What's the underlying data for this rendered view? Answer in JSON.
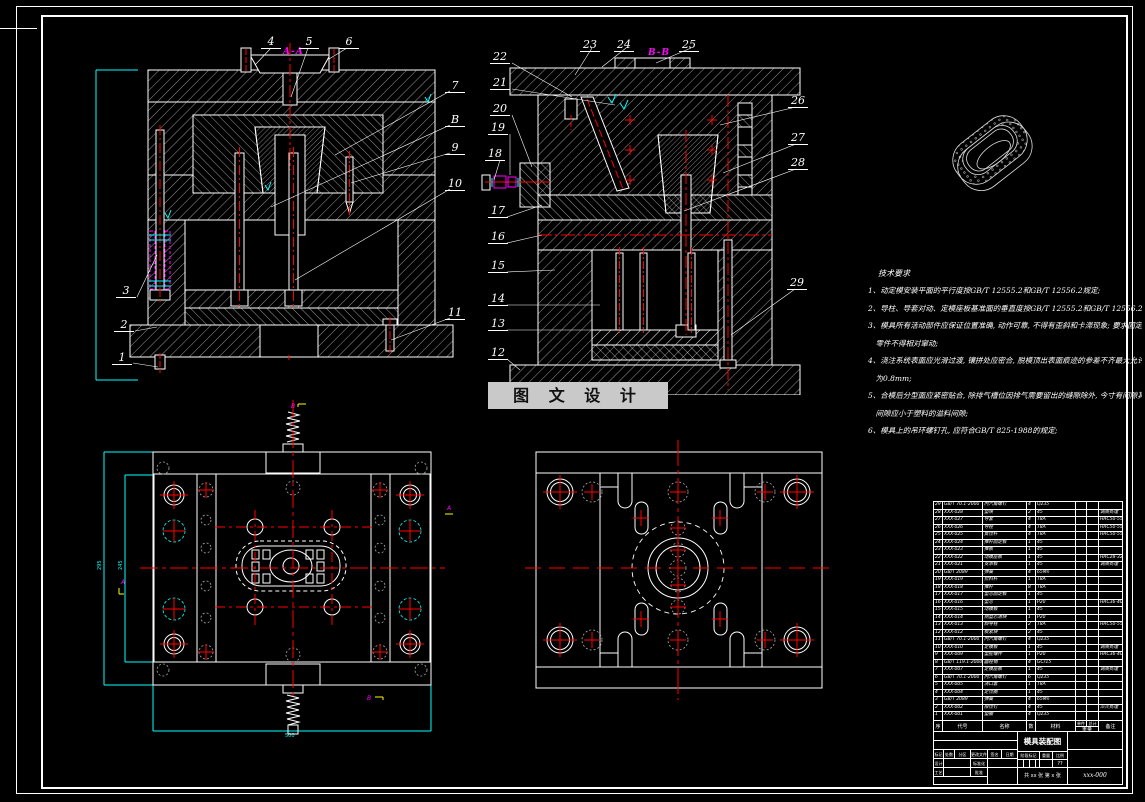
{
  "colors": {
    "background": "#000000",
    "line": "#ffffff",
    "centerline": "#ff0000",
    "dimension": "#00ffff",
    "highlight": "#ff00ff",
    "mark_yellow": "#ffff00",
    "watermark_bg": "#c9c9c9",
    "watermark_text": "#111111",
    "ghost_grey": "#aaaaaa"
  },
  "watermark": {
    "text": "图 文 设 计"
  },
  "section_labels": {
    "a": "A-A",
    "b": "B-B"
  },
  "view_a": {
    "callouts_top": [
      "4",
      "5",
      "6"
    ],
    "callouts_left": [
      "3",
      "2",
      "1"
    ],
    "callouts_right": [
      "7",
      "B",
      "9",
      "10",
      "11"
    ]
  },
  "view_b": {
    "callouts_top": [
      "23",
      "24",
      "25"
    ],
    "callouts_left": [
      "22",
      "21",
      "20",
      "19",
      "18",
      "17",
      "16",
      "15",
      "14",
      "13",
      "12"
    ],
    "callouts_right": [
      "26",
      "27",
      "28",
      "29"
    ]
  },
  "dims": {
    "view_a_height": "245",
    "plan_left_height": "295",
    "plan_left_inner": "245",
    "plan_left_width": "500"
  },
  "tech_notes": {
    "title": "技术要求",
    "lines": [
      "1、动定模安装平面的平行度按GB/T 12555.2和GB/T 12556.2规定;",
      "2、导柱、导套对动、定模座板基准面的垂直度按GB/T 12555.2和GB/T 12556.2;",
      "3、模具所有活动部件应保证位置准确, 动作可靠, 不得有歪斜和卡滞现象; 要求固定的",
      "　零件不得相对窜动;",
      "4、浇注系统表面应光滑过渡, 镶拼处应密合, 脱模顶出表面痕迹的参差不齐最大允许值",
      "　为0.8mm;",
      "5、合模后分型面应紧密贴合, 除排气槽位因排气需要留出的缝隙除外, 今寸有间隙其",
      "　间隙应小于塑料的溢料间隙;",
      "6、模具上的吊环螺钉孔, 应符合GB/T 825-1988的规定;"
    ]
  },
  "bom": {
    "headers": {
      "no": "序号",
      "code": "代号",
      "name": "名称",
      "qty": "数量",
      "mat": "材料",
      "weight": "重量",
      "unit": "单件",
      "total": "总计",
      "remark": "备注"
    },
    "rows": [
      {
        "no": "29",
        "code": "GB/T 70.1-2000",
        "name": "内六角螺钉",
        "qty": "4",
        "mat": "Q235",
        "unit": "",
        "total": "",
        "remark": ""
      },
      {
        "no": "28",
        "code": "XXX-028",
        "name": "垫块",
        "qty": "2",
        "mat": "45",
        "unit": "",
        "total": "",
        "remark": "调质处理"
      },
      {
        "no": "27",
        "code": "XXX-027",
        "name": "导套",
        "qty": "4",
        "mat": "T8A",
        "unit": "",
        "total": "",
        "remark": "HRC50-55"
      },
      {
        "no": "26",
        "code": "XXX-026",
        "name": "导柱",
        "qty": "4",
        "mat": "T8A",
        "unit": "",
        "total": "",
        "remark": "HRC50-55"
      },
      {
        "no": "25",
        "code": "XXX-025",
        "name": "复位杆",
        "qty": "4",
        "mat": "T8A",
        "unit": "",
        "total": "",
        "remark": "HRC50-55"
      },
      {
        "no": "24",
        "code": "XXX-024",
        "name": "推杆固定板",
        "qty": "1",
        "mat": "45",
        "unit": "",
        "total": "",
        "remark": ""
      },
      {
        "no": "23",
        "code": "XXX-023",
        "name": "推板",
        "qty": "1",
        "mat": "45",
        "unit": "",
        "total": "",
        "remark": ""
      },
      {
        "no": "22",
        "code": "XXX-022",
        "name": "动模座板",
        "qty": "1",
        "mat": "45",
        "unit": "",
        "total": "",
        "remark": "HRC28-32"
      },
      {
        "no": "21",
        "code": "XXX-021",
        "name": "支承板",
        "qty": "1",
        "mat": "45",
        "unit": "",
        "total": "",
        "remark": "调质处理"
      },
      {
        "no": "20",
        "code": "GB/T 2089",
        "name": "弹簧",
        "qty": "4",
        "mat": "65Mn",
        "unit": "",
        "total": "",
        "remark": ""
      },
      {
        "no": "19",
        "code": "XXX-019",
        "name": "拉料杆",
        "qty": "1",
        "mat": "T8A",
        "unit": "",
        "total": "",
        "remark": ""
      },
      {
        "no": "18",
        "code": "XXX-018",
        "name": "推杆",
        "qty": "8",
        "mat": "T8A",
        "unit": "",
        "total": "",
        "remark": ""
      },
      {
        "no": "17",
        "code": "XXX-017",
        "name": "型芯固定板",
        "qty": "1",
        "mat": "45",
        "unit": "",
        "total": "",
        "remark": ""
      },
      {
        "no": "16",
        "code": "XXX-016",
        "name": "型芯",
        "qty": "1",
        "mat": "P20",
        "unit": "",
        "total": "",
        "remark": "HRC36-40"
      },
      {
        "no": "15",
        "code": "XXX-015",
        "name": "动模板",
        "qty": "1",
        "mat": "45",
        "unit": "",
        "total": "",
        "remark": ""
      },
      {
        "no": "14",
        "code": "XXX-014",
        "name": "侧型芯滑块",
        "qty": "1",
        "mat": "P20",
        "unit": "",
        "total": "",
        "remark": ""
      },
      {
        "no": "13",
        "code": "XXX-013",
        "name": "斜导柱",
        "qty": "2",
        "mat": "T8A",
        "unit": "",
        "total": "",
        "remark": "HRC50-55"
      },
      {
        "no": "12",
        "code": "XXX-012",
        "name": "楔紧块",
        "qty": "2",
        "mat": "45",
        "unit": "",
        "total": "",
        "remark": ""
      },
      {
        "no": "11",
        "code": "GB/T 70.1-2000",
        "name": "内六角螺钉",
        "qty": "4",
        "mat": "Q235",
        "unit": "",
        "total": "",
        "remark": ""
      },
      {
        "no": "10",
        "code": "XXX-010",
        "name": "定模板",
        "qty": "1",
        "mat": "45",
        "unit": "",
        "total": "",
        "remark": "调质处理"
      },
      {
        "no": "9",
        "code": "XXX-009",
        "name": "型腔镶件",
        "qty": "1",
        "mat": "P20",
        "unit": "",
        "total": "",
        "remark": "HRC36-40"
      },
      {
        "no": "8",
        "code": "GB/T 119.1-2000",
        "name": "圆柱销",
        "qty": "4",
        "mat": "GCr15",
        "unit": "",
        "total": "",
        "remark": ""
      },
      {
        "no": "7",
        "code": "XXX-007",
        "name": "定模座板",
        "qty": "1",
        "mat": "45",
        "unit": "",
        "total": "",
        "remark": "调质处理"
      },
      {
        "no": "6",
        "code": "GB/T 70.1-2000",
        "name": "内六角螺钉",
        "qty": "6",
        "mat": "Q235",
        "unit": "",
        "total": "",
        "remark": ""
      },
      {
        "no": "5",
        "code": "XXX-005",
        "name": "浇口套",
        "qty": "1",
        "mat": "T8A",
        "unit": "",
        "total": "",
        "remark": ""
      },
      {
        "no": "4",
        "code": "XXX-004",
        "name": "定位圈",
        "qty": "1",
        "mat": "45",
        "unit": "",
        "total": "",
        "remark": ""
      },
      {
        "no": "3",
        "code": "GB/T 2089",
        "name": "弹簧",
        "qty": "4",
        "mat": "65Mn",
        "unit": "",
        "total": "",
        "remark": ""
      },
      {
        "no": "2",
        "code": "XXX-002",
        "name": "限位钉",
        "qty": "4",
        "mat": "45",
        "unit": "",
        "total": "",
        "remark": "淬火处理"
      },
      {
        "no": "1",
        "code": "XXX-001",
        "name": "垫圈",
        "qty": "4",
        "mat": "Q235",
        "unit": "",
        "total": "",
        "remark": ""
      }
    ]
  },
  "title_block": {
    "title": "模具装配图",
    "drawing_no": "xxx-000",
    "sheet_info": "共 xx 张  第 x 张",
    "scale_value": "??",
    "rev_labels": [
      "标记",
      "处数",
      "分区",
      "更改文件号",
      "签名",
      "日期"
    ],
    "left_labels": [
      "设计",
      "标准化",
      "工艺",
      "批准"
    ],
    "stage_labels": [
      "阶段标记",
      "重量",
      "比例"
    ]
  }
}
